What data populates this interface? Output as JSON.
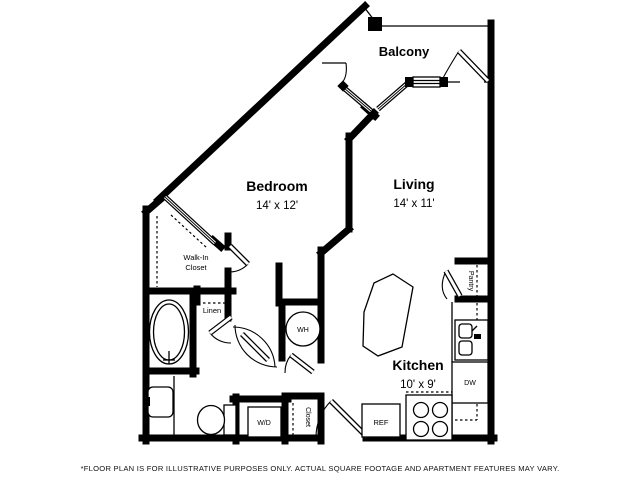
{
  "floorplan": {
    "rooms": {
      "balcony": {
        "label": "Balcony"
      },
      "bedroom": {
        "label": "Bedroom",
        "dimensions": "14' x 12'"
      },
      "living": {
        "label": "Living",
        "dimensions": "14' x 11'"
      },
      "kitchen": {
        "label": "Kitchen",
        "dimensions": "10' x 9'"
      },
      "walk_in_closet": {
        "label_line1": "Walk-In",
        "label_line2": "Closet"
      },
      "linen": {
        "label": "Linen"
      },
      "entry_closet": {
        "label": "Closet"
      },
      "pantry": {
        "label": "Pantry"
      }
    },
    "fixtures": {
      "water_heater": {
        "label": "WH"
      },
      "washer_dryer": {
        "label": "W/D"
      },
      "refrigerator": {
        "label": "REF"
      },
      "dishwasher": {
        "label": "DW"
      }
    },
    "colors": {
      "wall": "#000000",
      "background": "#ffffff"
    },
    "disclaimer": "*FLOOR PLAN IS FOR ILLUSTRATIVE PURPOSES ONLY. ACTUAL SQUARE FOOTAGE AND APARTMENT FEATURES MAY VARY."
  }
}
